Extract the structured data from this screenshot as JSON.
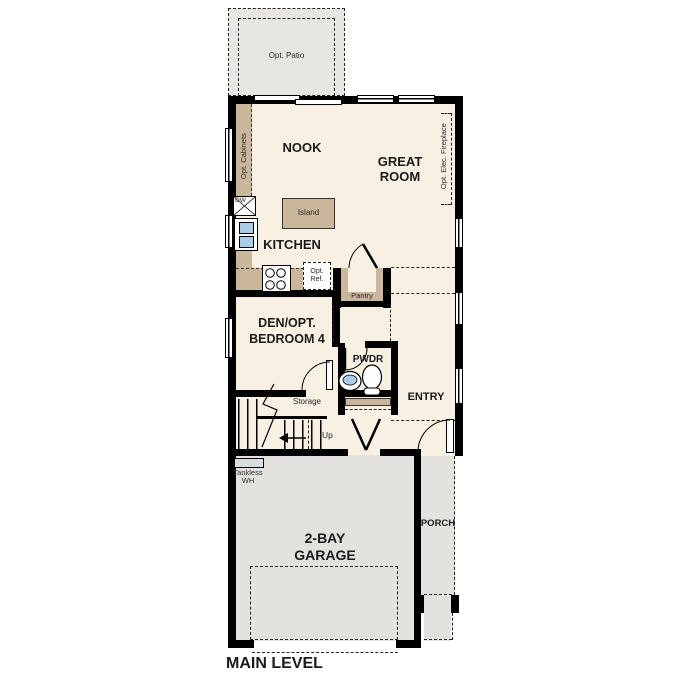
{
  "title": "MAIN LEVEL",
  "colors": {
    "wall": "#000000",
    "floor": "#f7f0e3",
    "concrete": "#e3e2de",
    "patio": "#e7e6e2",
    "counter": "#c9b69b",
    "sink_blue": "#a9cce9",
    "appliance": "#d9dee0"
  },
  "labels": {
    "opt_patio": "Opt. Patio",
    "nook": "NOOK",
    "great_room_line1": "GREAT",
    "great_room_line2": "ROOM",
    "opt_fireplace": "Opt. Elec. Fireplace",
    "opt_cabinets": "Opt. Cabinets",
    "dw": "DW",
    "island": "Island",
    "kitchen": "KITCHEN",
    "opt_ref_line1": "Opt.",
    "opt_ref_line2": "Ref.",
    "pantry": "Pantry",
    "den_line1": "DEN/OPT.",
    "den_line2": "BEDROOM 4",
    "pwdr": "PWDR",
    "entry": "ENTRY",
    "storage": "Storage",
    "up": "Up",
    "tankless_line1": "Tankless",
    "tankless_line2": "WH",
    "garage_line1": "2-BAY",
    "garage_line2": "GARAGE",
    "porch": "PORCH",
    "main_level": "MAIN LEVEL"
  }
}
